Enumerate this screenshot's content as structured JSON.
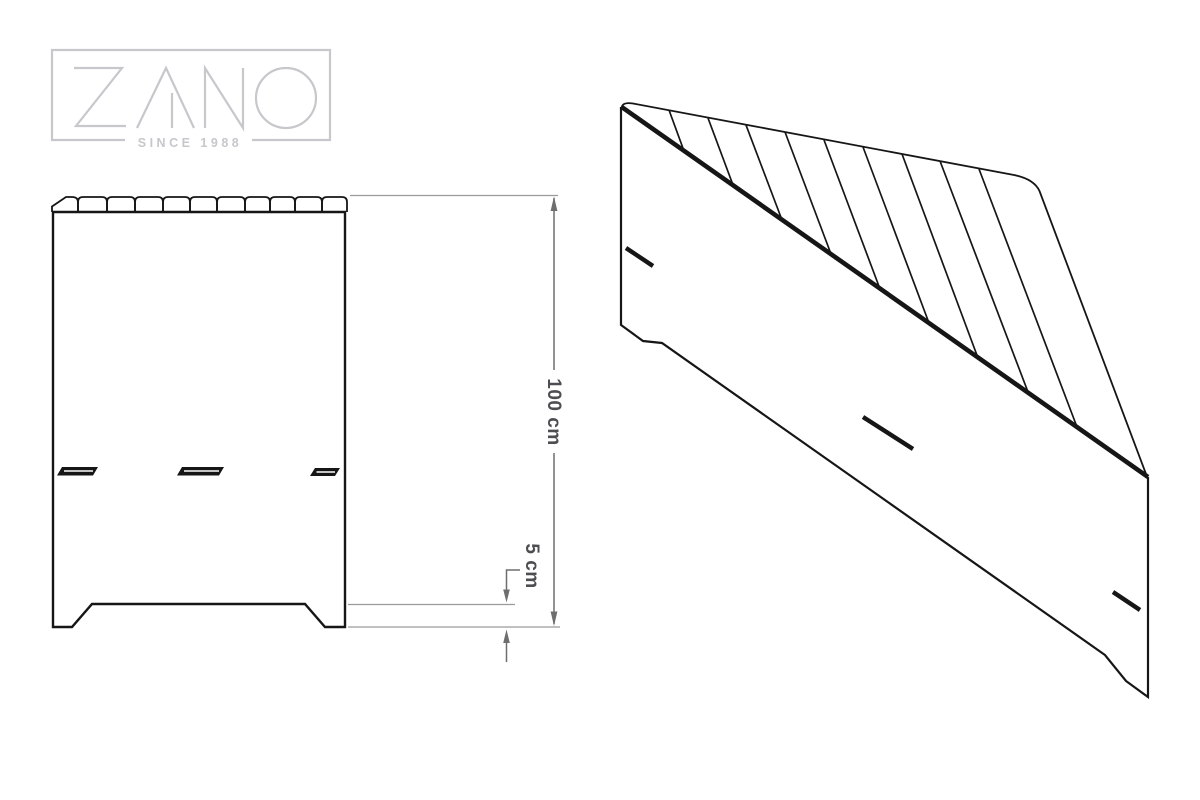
{
  "logo": {
    "brand": "ZANO",
    "tagline": "SINCE 1988"
  },
  "dimensions": {
    "height": {
      "label": "100 cm"
    },
    "foot_height": {
      "label": "5 cm"
    }
  },
  "colors": {
    "line": "#161616",
    "dimension": "#6e6e70",
    "dimension_text": "#4e4e52",
    "extension": "#9b9b9b",
    "logo": "#c7c7cc",
    "background": "#ffffff"
  }
}
